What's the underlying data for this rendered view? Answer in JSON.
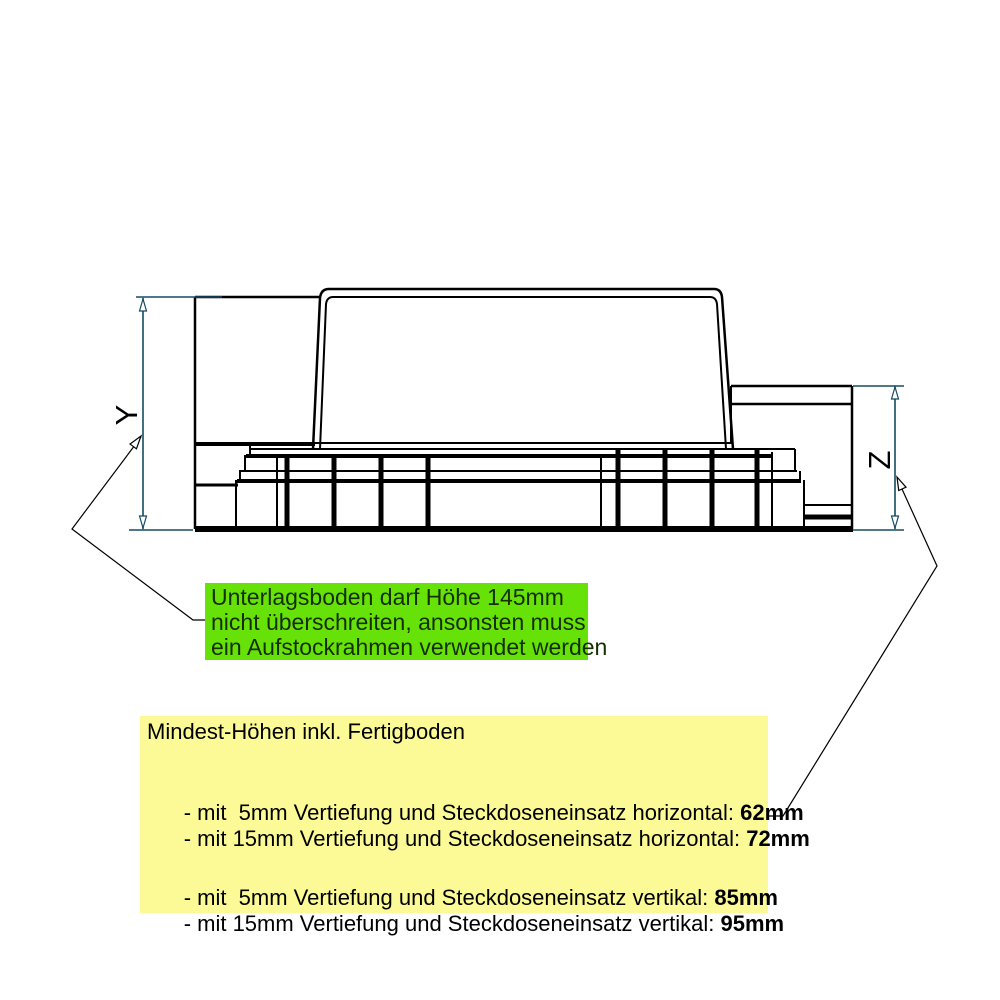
{
  "drawing": {
    "dimension_labels": {
      "y": "Y",
      "z": "Z"
    },
    "colors": {
      "drawing_line": "#000000",
      "dimension_line": "#164a63",
      "warning_note_bg": "#66e209",
      "info_note_bg": "#fbfa96"
    }
  },
  "green_note": {
    "lines": [
      "Unterlagsboden darf Höhe 145mm",
      "nicht überschreiten, ansonsten muss",
      "ein Aufstockrahmen verwendet werden"
    ]
  },
  "yellow_note": {
    "title": "Mindest-Höhen inkl. Fertigboden",
    "rows": [
      {
        "text": "- mit  5mm Vertiefung und Steckdoseneinsatz horizontal: ",
        "value": "62mm"
      },
      {
        "text": "- mit 15mm Vertiefung und Steckdoseneinsatz horizontal: ",
        "value": "72mm"
      },
      {
        "text": "- mit  5mm Vertiefung und Steckdoseneinsatz vertikal: ",
        "value": "85mm"
      },
      {
        "text": "- mit 15mm Vertiefung und Steckdoseneinsatz vertikal: ",
        "value": "95mm"
      }
    ]
  }
}
